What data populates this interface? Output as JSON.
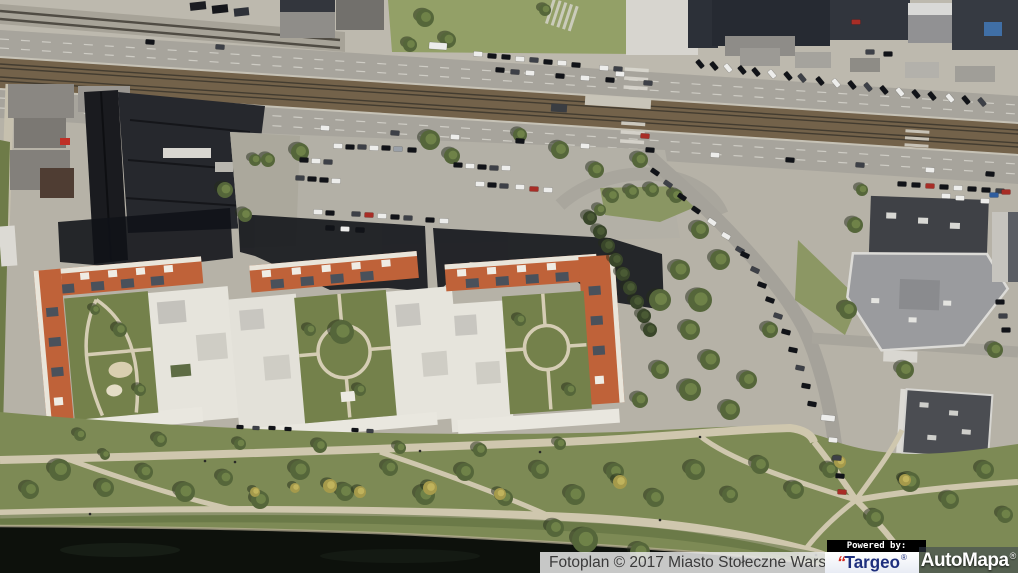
{
  "attribution": {
    "text": "Fotoplan © 2017 Miasto Stołeczne Warszawa"
  },
  "powered_by": {
    "label": "Powered by:"
  },
  "logos": {
    "targeo": {
      "quote_mark": "“",
      "text": "Targeo",
      "registered": "®",
      "text_color": "#1e2f7d",
      "mark_color": "#d5281e",
      "bg_color": "#ffffff"
    },
    "automapa": {
      "text": "AutoMapa",
      "registered": "®",
      "text_color": "#ffffff"
    }
  }
}
